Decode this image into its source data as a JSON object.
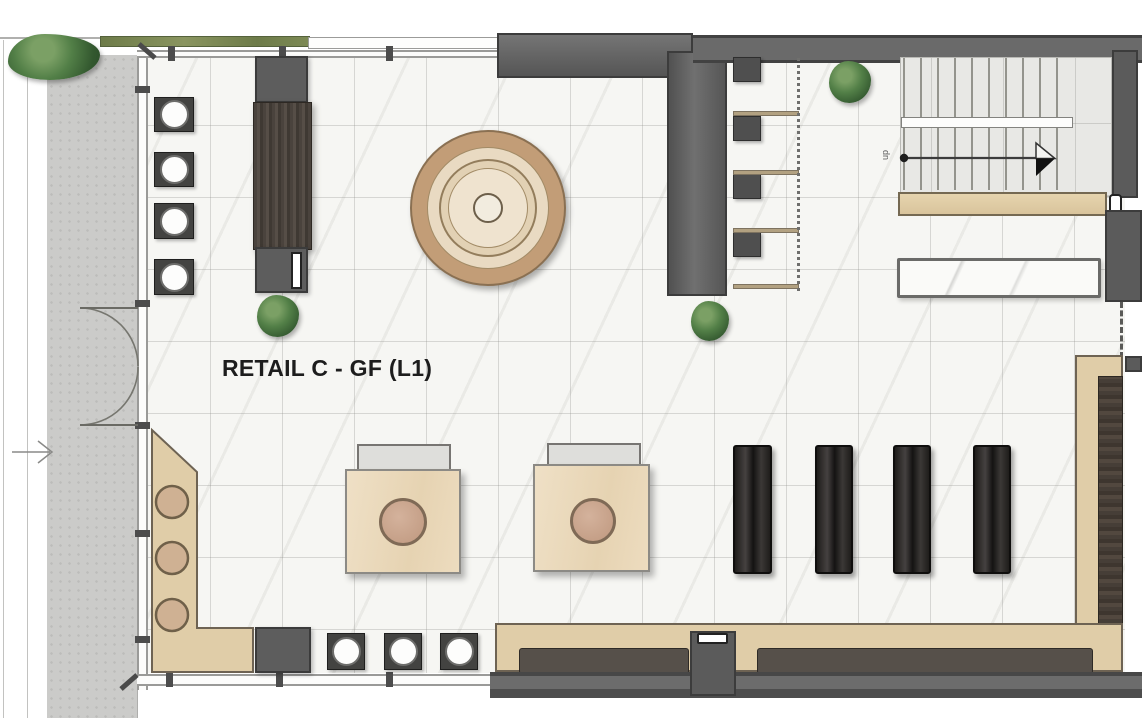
{
  "plan": {
    "room_label": "RETAIL C - GF (L1)",
    "stairs": {
      "direction_label": "up"
    },
    "counts": {
      "left_planters": 4,
      "bottom_planters": 3,
      "display_benches": 4,
      "counter_stools": 3,
      "display_tables": 2,
      "hanging_rails": 4,
      "trees": 4
    },
    "colors": {
      "wall_dark": "#5b5b5b",
      "wall_outline": "#3c3c3c",
      "wood_light": "#e0cda8",
      "wood_dark": "#4a423b",
      "floor_marble": "#f6f6f3",
      "pavement_gray": "#cbcbc9",
      "hedge_green": "#75824e",
      "tree_green": "#4d7a44",
      "bench_black": "#23211f",
      "stool_tan": "#cfb193",
      "rug_ring_tan": "#c29d77"
    }
  }
}
